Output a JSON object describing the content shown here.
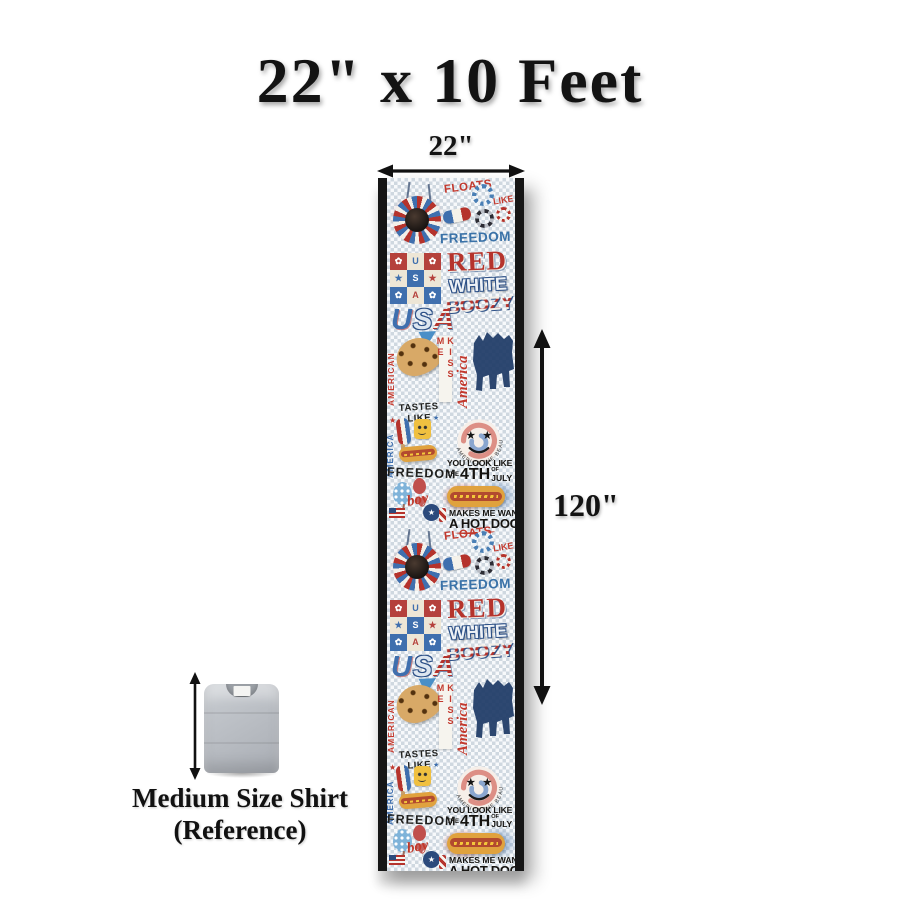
{
  "title": "22\" x 10 Feet",
  "dimensions": {
    "width_label": "22\"",
    "height_label": "120\""
  },
  "reference": {
    "line1": "Medium Size Shirt",
    "line2": "(Reference)"
  },
  "icons": {
    "star": "★",
    "daisy": "✿",
    "sparkle": "★"
  },
  "colors": {
    "red": "#b5332c",
    "blue": "#3f6fae",
    "navy": "#1e3a66",
    "ink": "#131313",
    "checker": "#cfd8e0",
    "shirt_gray": "#b9bdc3"
  },
  "pattern": {
    "repeats": 2,
    "floats": "FLOATS",
    "like": "LIKE",
    "freedom_top": "FREEDOM",
    "checker_cells": [
      "✿",
      "U",
      "✿",
      "★",
      "S",
      "★",
      "✿",
      "A",
      "✿"
    ],
    "red": "RED",
    "white": "WHITE",
    "boozy": "BOOZY",
    "usa_letters": [
      "U",
      "S",
      "A"
    ],
    "american_side": "AMERICAN",
    "america_side": "AMERICA",
    "kiss_me": "KISS ME",
    "america_script": "America",
    "tastes_like": "TASTES LIKE",
    "freedom_arch": "FREEDOM",
    "smiley_caption": "AMERICA THE BEAUTIFUL",
    "boy": "boy",
    "you_look": "YOU LOOK LIKE",
    "the": "THE",
    "fourth": "4TH",
    "of": "OF",
    "july": "JULY",
    "makes": "MAKES ME WANT",
    "a_hot_dog": "A HOT DOG"
  }
}
